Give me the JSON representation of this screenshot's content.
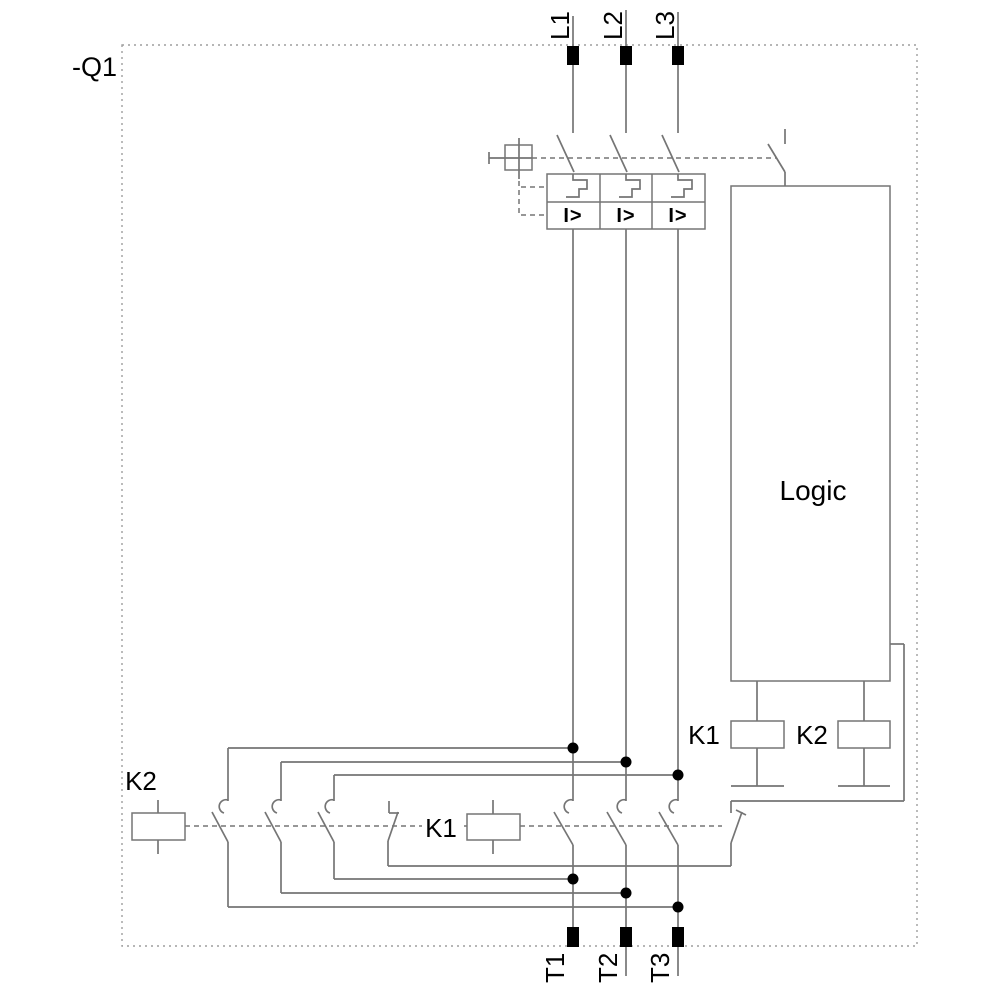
{
  "device": {
    "tag": "-Q1"
  },
  "input_terminals": {
    "l1": "L1",
    "l2": "L2",
    "l3": "L3"
  },
  "output_terminals": {
    "t1": "T1",
    "t2": "T2",
    "t3": "T3"
  },
  "circuit_breaker": {
    "overcurrent_label": "I>"
  },
  "logic_block": {
    "label": "Logic"
  },
  "relay_coils": {
    "k1": "K1",
    "k2": "K2"
  },
  "contactor_k1": {
    "label": "K1"
  },
  "contactor_k2": {
    "label": "K2"
  },
  "colors": {
    "wire": "#757575",
    "device_border": "#9e9e9e",
    "text": "#000000",
    "terminal_fill": "#000000",
    "background": "#ffffff"
  }
}
